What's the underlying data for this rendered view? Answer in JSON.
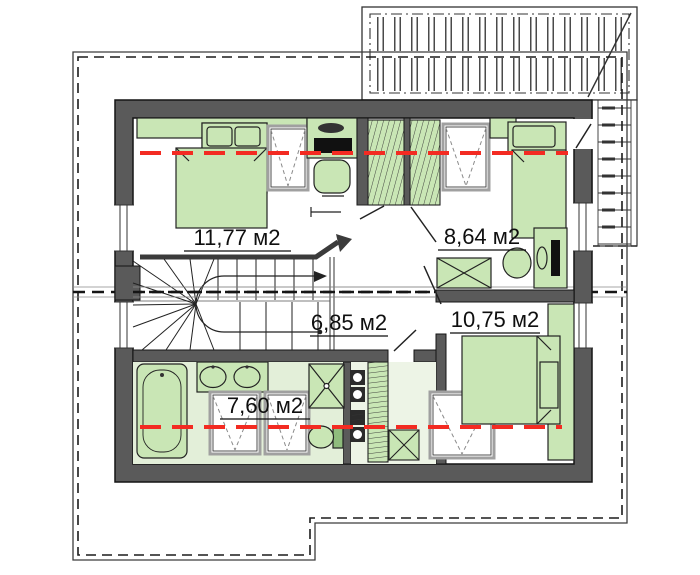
{
  "plan": {
    "type": "attic-floor-plan",
    "rooms": [
      {
        "name": "bedroom-left",
        "label": "11,77 м2"
      },
      {
        "name": "bedroom-right",
        "label": "8,64 м2"
      },
      {
        "name": "hall",
        "label": "6,85 м2"
      },
      {
        "name": "bedroom-bottom",
        "label": "10,75 м2"
      },
      {
        "name": "bathroom",
        "label": "7,60 м2"
      }
    ],
    "colors": {
      "furniture_green": "#c9e6b5",
      "wall_gray": "#5a5a5a",
      "height_line_red": "#f32b22",
      "bathroom_floor": "#e3efd9",
      "outline_dark": "#333333"
    }
  }
}
